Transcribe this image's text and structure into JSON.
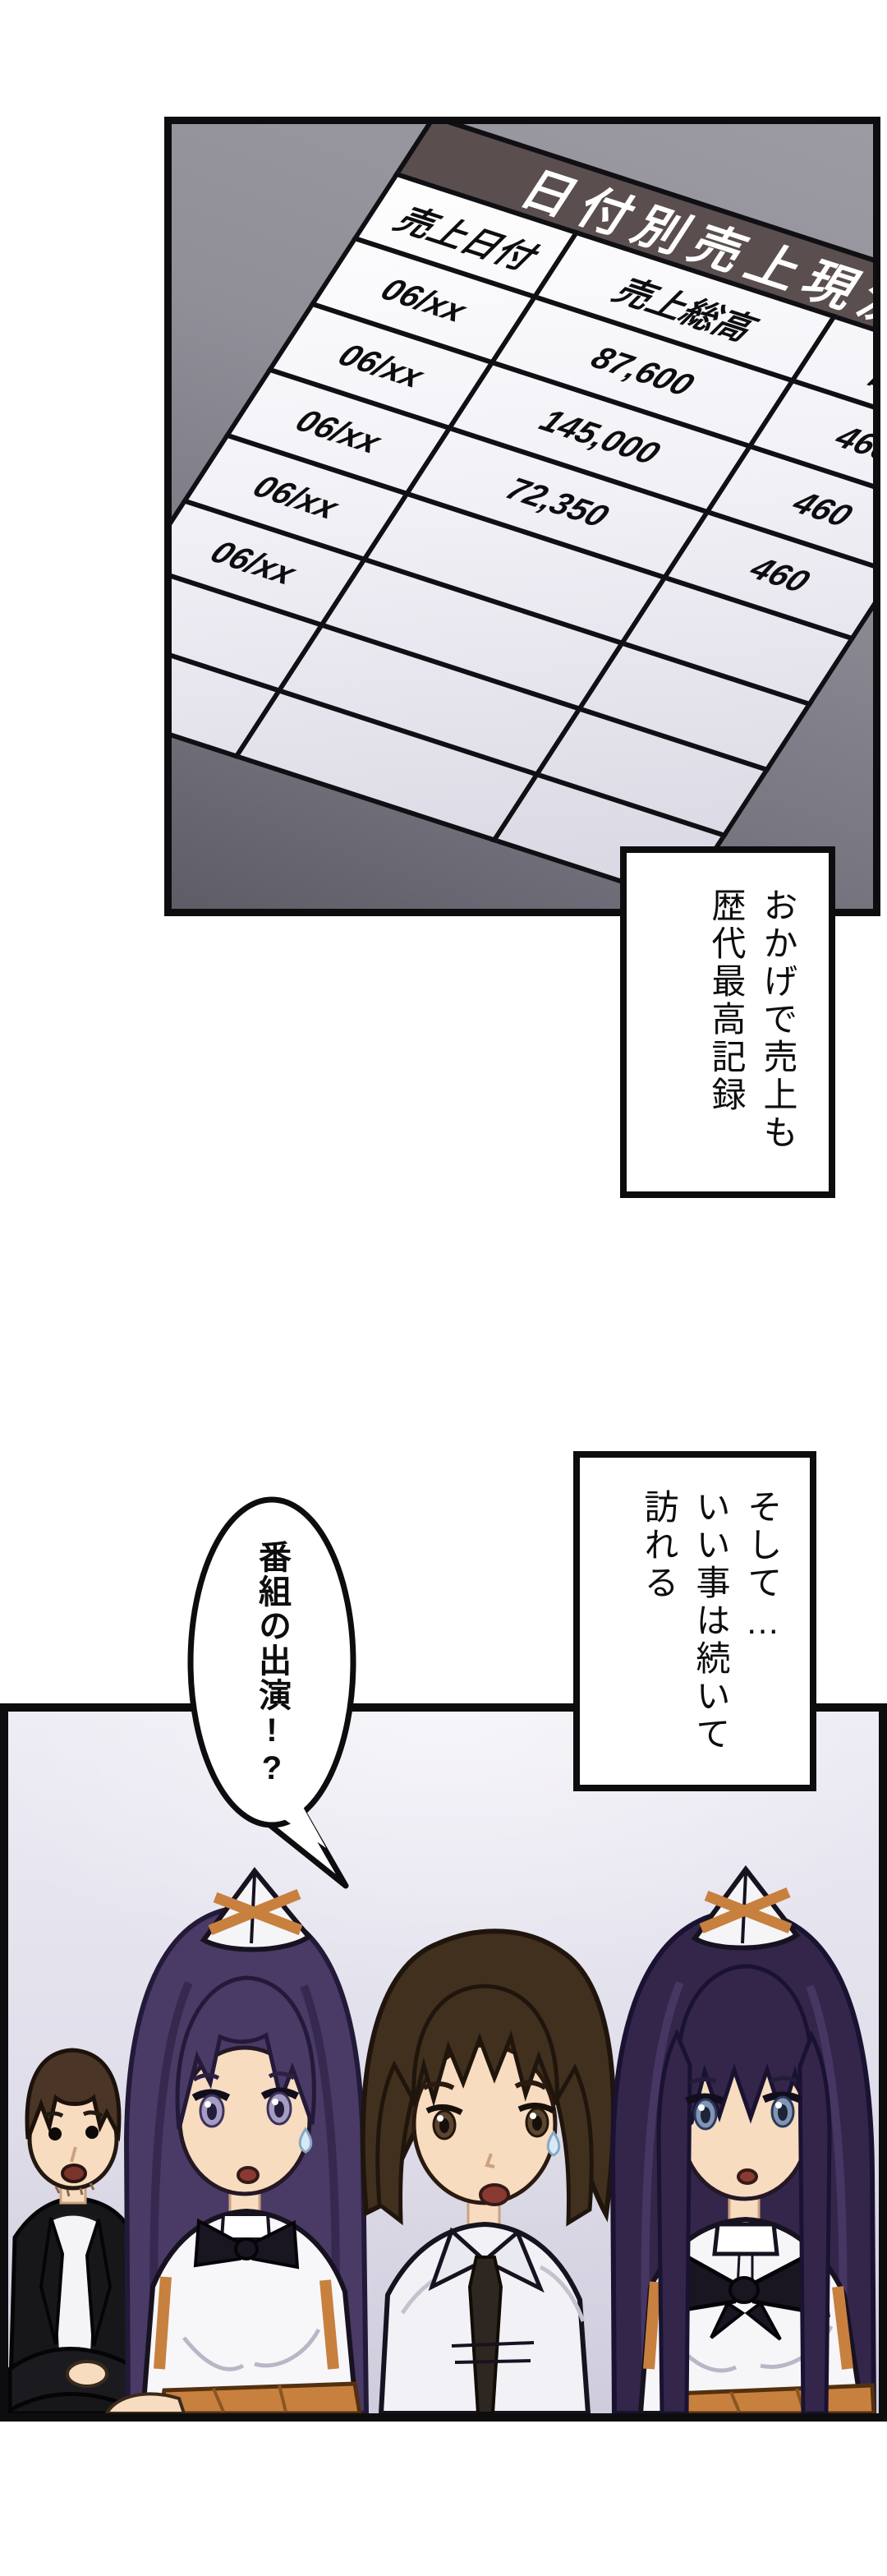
{
  "report": {
    "title": "日付別売上現況",
    "columns": [
      "売上日付",
      "売上総高",
      "割引"
    ],
    "rows": [
      [
        "06/xx",
        "87,600",
        "460"
      ],
      [
        "06/xx",
        "145,000",
        "460"
      ],
      [
        "06/xx",
        "72,350",
        "460"
      ],
      [
        "06/xx",
        "",
        ""
      ],
      [
        "06/xx",
        "",
        ""
      ],
      [
        "",
        "",
        ""
      ],
      [
        "",
        "",
        ""
      ]
    ]
  },
  "narration1": {
    "lines": [
      "おかげで売上も",
      "歴代最高記録"
    ]
  },
  "narration2": {
    "lines": [
      "そして…",
      "いい事は続いて",
      "訪れる"
    ]
  },
  "bubble": {
    "text": "番組の出演!?"
  },
  "colors": {
    "ink": "#0d0d0f",
    "band": "#5a4e4e",
    "apron": "#c8803f",
    "skin": "#f8dcc0",
    "hair-left-girl": "#4a3a66",
    "hair-right-girl": "#33264a",
    "hair-guy": "#42301f",
    "hair-man": "#4a3526"
  }
}
